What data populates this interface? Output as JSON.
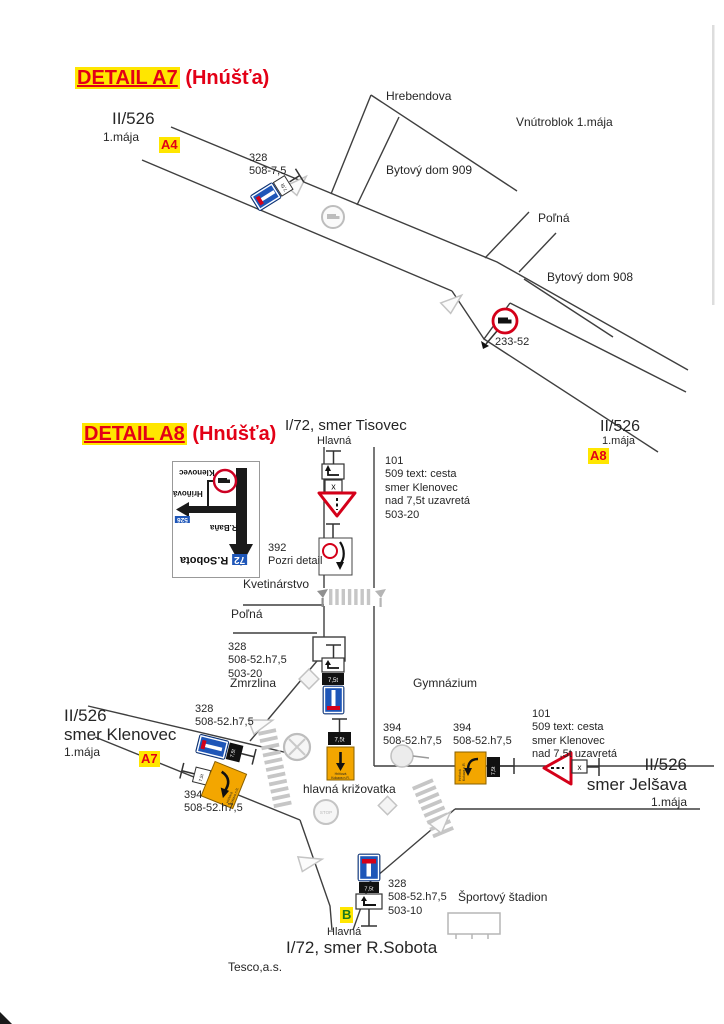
{
  "a7": {
    "title": "DETAIL A7",
    "title_suffix": " (Hnúšťa)",
    "ref": "II/526",
    "street": "1.mája",
    "badge": "A4",
    "hrebendova": "Hrebendova",
    "vnutroblok": "Vnútroblok 1.mája",
    "bytovy909": "Bytový dom 909",
    "polna": "Poľná",
    "bytovy908": "Bytový dom 908",
    "sign328": "328\n508-7,5",
    "sign233": "233-52",
    "end_ref": "II/526",
    "end_street": "1.mája",
    "end_badge": "A8"
  },
  "a8": {
    "title": "DETAIL A8",
    "title_suffix": " (Hnúšťa)",
    "north_ref": "I/72, smer Tisovec",
    "north_street": "Hlavná",
    "note_north": "101\n509 text: cesta\nsmer Klenovec\nnad 7,5t uzavretá\n503-20",
    "sign392": "392\nPozri detail",
    "kvetinarstvo": "Kvetinárstvo",
    "polna": "Poľná",
    "sign328_center": "328\n508-52.h7,5\n503-20",
    "zmrzlina": "Zmrzlina",
    "gymnazium": "Gymnázium",
    "west_ref": "II/526",
    "west_dir": "smer Klenovec",
    "west_street": "1.mája",
    "west_badge": "A7",
    "sign328_west": "328\n508-52.h7,5",
    "sign394_west": "394\n508-52.h7,5",
    "krizovatka": "hlavná križovatka",
    "sign394_mid": "394\n508-52.h7,5",
    "sign394_east": "394\n508-52.h7,5",
    "note_east": "101\n509 text: cesta\nsmer Klenovec\nnad 7,5t uzavretá",
    "east_ref": "II/526",
    "east_dir": "smer Jelšava",
    "east_street": "1.mája",
    "sign328_south": "328\n508-52.h7,5\n503-10",
    "stadion": "Športový štadion",
    "south_badge": "B",
    "south_street": "Hlavná",
    "south_ref": "I/72, smer R.Sobota",
    "tesco": "Tesco,a.s.",
    "detour_line1": "Hriňová",
    "detour_line2": "Kokava n.R.",
    "inset": {
      "klenovec": "Klenovec",
      "hrinova": "Hriňová",
      "shield526": "526",
      "rbana": "R.Baňa",
      "shield72": "72",
      "rsobota": "R.Sobota"
    }
  },
  "signs": {
    "weight": "7,5t",
    "x": "x",
    "stop": "STOP"
  },
  "colors": {
    "title_red": "#e30016",
    "highlight_yellow": "#ffe600",
    "sign_blue": "#1e56b8",
    "sign_orange": "#f3a600",
    "sign_red": "#d40019",
    "road_gray": "#3f3f3f",
    "ghost_gray": "#c4c4c4"
  }
}
